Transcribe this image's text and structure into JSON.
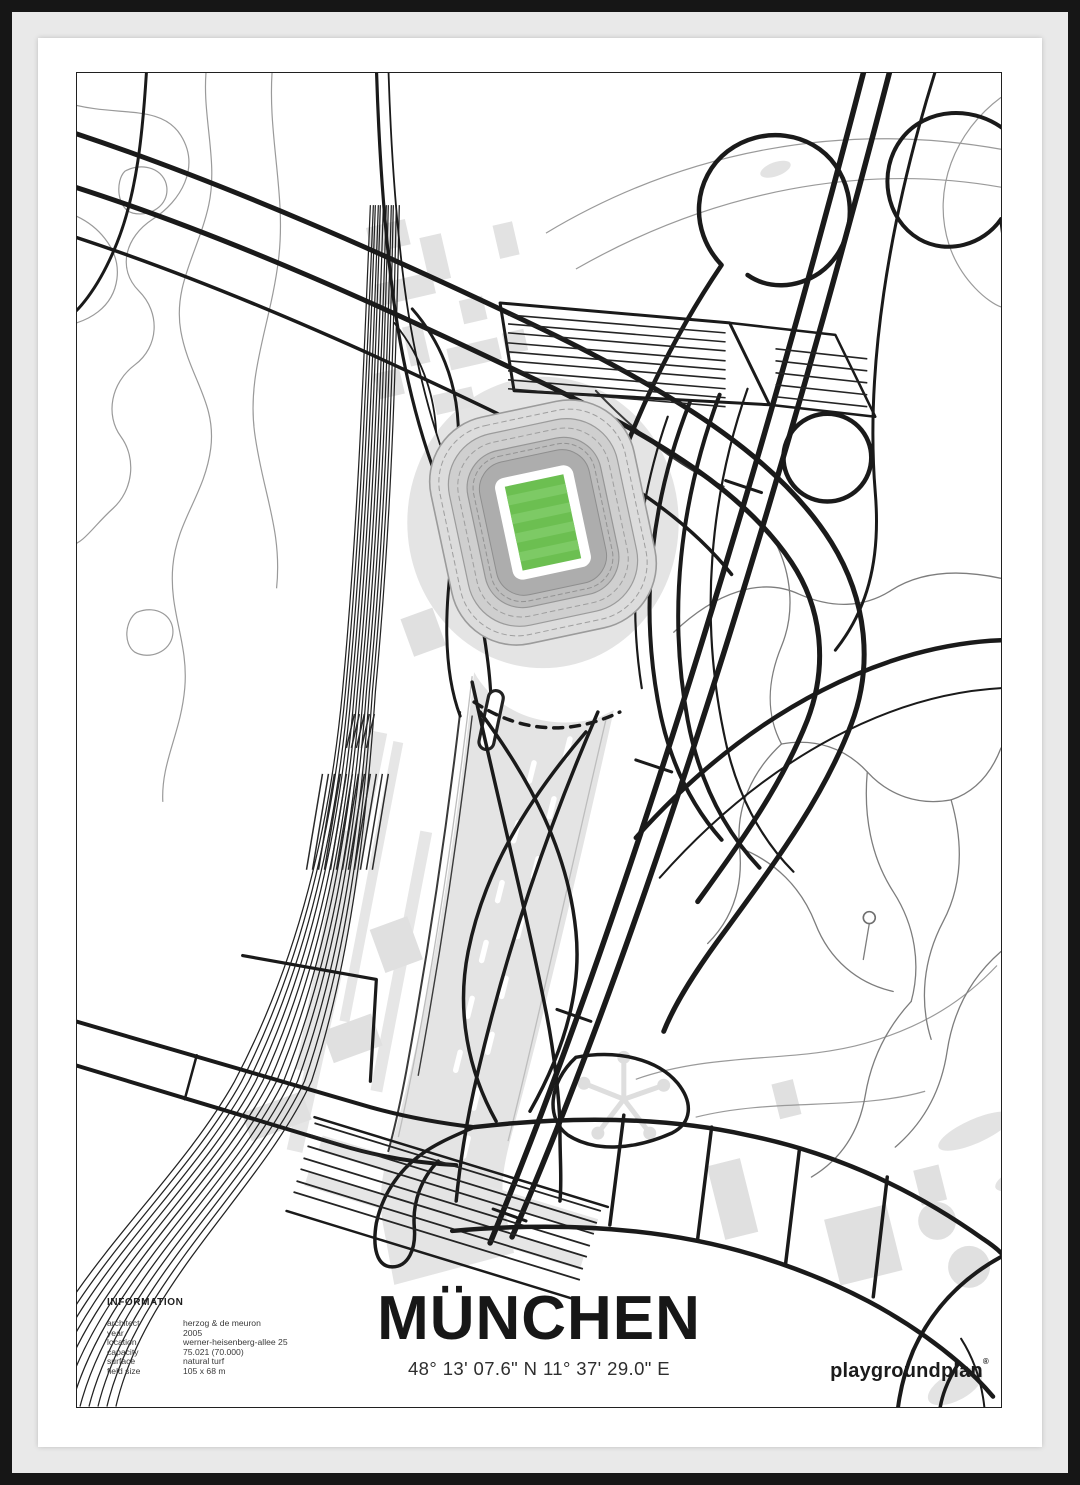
{
  "poster": {
    "title": "MÜNCHEN",
    "coordinates": "48° 13' 07.6\" N 11° 37' 29.0\" E",
    "brand": {
      "name": "playgroundplan",
      "registered_mark": "®"
    },
    "information": {
      "heading": "INFORMATION",
      "rows": [
        {
          "label": "architect",
          "value": "herzog & de meuron"
        },
        {
          "label": "year",
          "value": "2005"
        },
        {
          "label": "location",
          "value": "werner-heisenberg-allee 25"
        },
        {
          "label": "capacity",
          "value": "75.021 (70.000)"
        },
        {
          "label": "surface",
          "value": "natural turf"
        },
        {
          "label": "field size",
          "value": "105 x 68 m"
        }
      ]
    }
  },
  "colors": {
    "frame": "#161616",
    "matte": "#e9e9e9",
    "paper": "#ffffff",
    "line": "#1a1a1a",
    "pitch_green": "#6cbf51",
    "pitch_green_light": "#7dca65",
    "map_gray": "#e4e4e4"
  }
}
